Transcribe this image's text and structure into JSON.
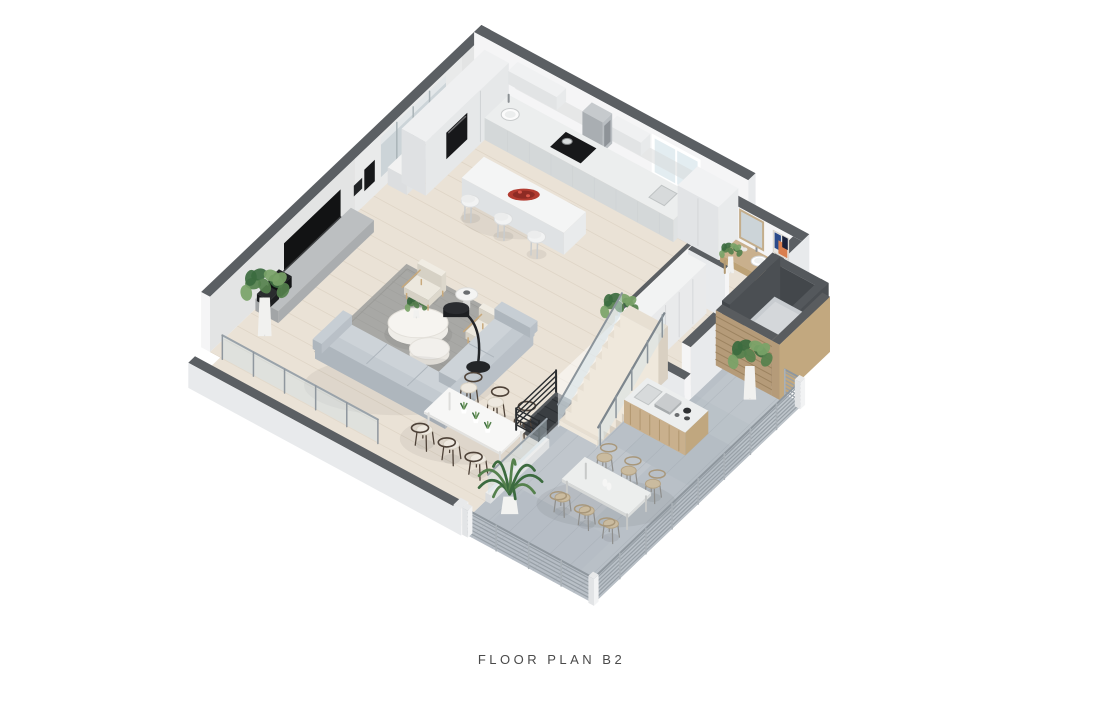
{
  "caption": {
    "label": "FLOOR PLAN B2"
  },
  "scene": {
    "type": "isometric-3d-floor-plan-render",
    "rooms_visible": [
      "kitchen",
      "living room",
      "dining area",
      "powder room",
      "hallway",
      "staircase",
      "elevator shaft",
      "terrace",
      "balcony"
    ],
    "furniture_visible": [
      "kitchen island with 3 bar stools",
      "L-shaped sectional sofa",
      "area rug",
      "organic coffee table",
      "two armchairs",
      "arc floor lamp",
      "media console with TV",
      "sideboard with bowl",
      "dining table with 6 wishbone chairs",
      "vanity with vessel sink and mirror",
      "wall artwork",
      "wardrobe",
      "outdoor bar counter with sink and grill",
      "outdoor dining table with 6 chairs",
      "potted plants",
      "glass balustrade",
      "metal slat railing"
    ]
  },
  "palette": {
    "background": "#ffffff",
    "captionColor": "#4a4a4a",
    "wallTop": "#5b5f63",
    "wallFace": "#f5f5f6",
    "wallShade": "#e8eaec",
    "wallInner": "#e3e4e4",
    "woodFloor": "#eae2d6",
    "plankLine": "#dcd2c3",
    "terraceFloor": "#b9c0c7",
    "terraceShade": "#aab2ba",
    "rug": "#a8a8a5",
    "rugLine": "#9b9b98",
    "sofaTop": "#cdd3d8",
    "sofaSide": "#b9c0c7",
    "sofaDark": "#aeb6bd",
    "cream": "#ece8de",
    "creamShade": "#ddd8cc",
    "woodCabinet": "#c9b08d",
    "woodCabinetDark": "#b0966f",
    "slatWood": "#b59b79",
    "slatLine": "#9c8360",
    "glass": "#cfe0e8",
    "metalRail": "#98a0a7",
    "darkRail": "#2a2d30",
    "black": "#17181a",
    "steel": "#b9bec2",
    "counterTop": "#eceeee",
    "counterSide": "#dfe2e3",
    "counterDark": "#d4d8d9",
    "stairTread": "#e7dfd2",
    "stairRiser": "#efe8dc",
    "stairSideC": "#d9d0c2",
    "white": "#fafafa",
    "elevatorTop": "#54585c",
    "elevatorPit": "#2f3336",
    "elevatorCab": "#c8ccd0",
    "accentRed": "#b23b30",
    "accentRedDark": "#8e2b24",
    "green": "#55814d",
    "greenDark": "#3c6b3f",
    "greenLight": "#79a368",
    "tvBlack": "#121314",
    "artBlue": "#2b4a8a",
    "artOrange": "#d97f4e",
    "artNavy": "#18203a",
    "mirror": "#ccd4d8",
    "windowPane": "#e3edf1"
  }
}
